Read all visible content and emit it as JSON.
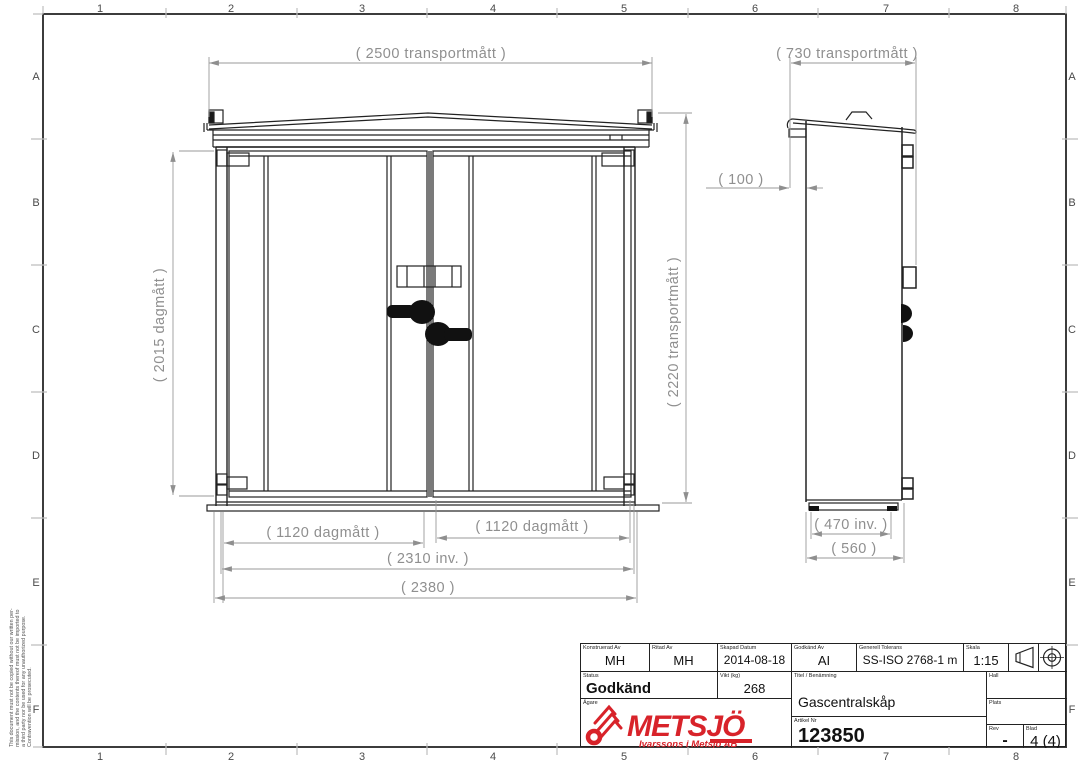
{
  "sheet": {
    "grid_cols": [
      "1",
      "2",
      "3",
      "4",
      "5",
      "6",
      "7",
      "8"
    ],
    "grid_rows": [
      "A",
      "B",
      "C",
      "D",
      "E",
      "F"
    ]
  },
  "dims": {
    "front_width": "( 2500 transportmått )",
    "front_opening_height": "( 2015 dagmått )",
    "front_total_height": "( 2220 transportmått )",
    "door_left_opening": "( 1120 dagmått )",
    "door_right_opening": "( 1120 dagmått )",
    "inner_width": "( 2310 inv. )",
    "outer_width": "( 2380 )",
    "side_width": "( 730 transportmått )",
    "side_roof_offset": "( 100 )",
    "side_inner_depth": "( 470 inv. )",
    "side_outer_depth": "( 560 )"
  },
  "disclaimer": [
    "This document must not be copied without our written per-",
    "mission, and the contents thereof must not be imported to",
    "a third party nor be used for any unauthorized purpose.",
    "Contravention will be prosecuted."
  ],
  "title_block": {
    "konstruerad": {
      "label": "Konstruerad Av",
      "value": "MH"
    },
    "ritad": {
      "label": "Ritad Av",
      "value": "MH"
    },
    "skapad": {
      "label": "Skapad Datum",
      "value": "2014-08-18"
    },
    "godkand_av": {
      "label": "Godkänd Av",
      "value": "AI"
    },
    "tolerans": {
      "label": "Generell Tolerans",
      "value": "SS-ISO 2768-1 m"
    },
    "skala": {
      "label": "Skala",
      "value": "1:15"
    },
    "status": {
      "label": "Status",
      "value": "Godkänd"
    },
    "vikt": {
      "label": "Vikt (kg)",
      "value": "268"
    },
    "titel": {
      "label": "Titel / Benämning",
      "value": "Gascentralskåp"
    },
    "agare": {
      "label": "Ägare"
    },
    "hall": {
      "label": "Hall",
      "value": ""
    },
    "plats": {
      "label": "Plats",
      "value": ""
    },
    "artikel": {
      "label": "Artikel Nr",
      "value": "123850"
    },
    "rev": {
      "label": "Rev",
      "value": "-"
    },
    "blad": {
      "label": "Blad",
      "value": "4 (4)"
    },
    "logo": {
      "name": "METSJÖ",
      "subtitle": "Ivarssons i Metsjö AB",
      "color": "#d8232a"
    }
  }
}
